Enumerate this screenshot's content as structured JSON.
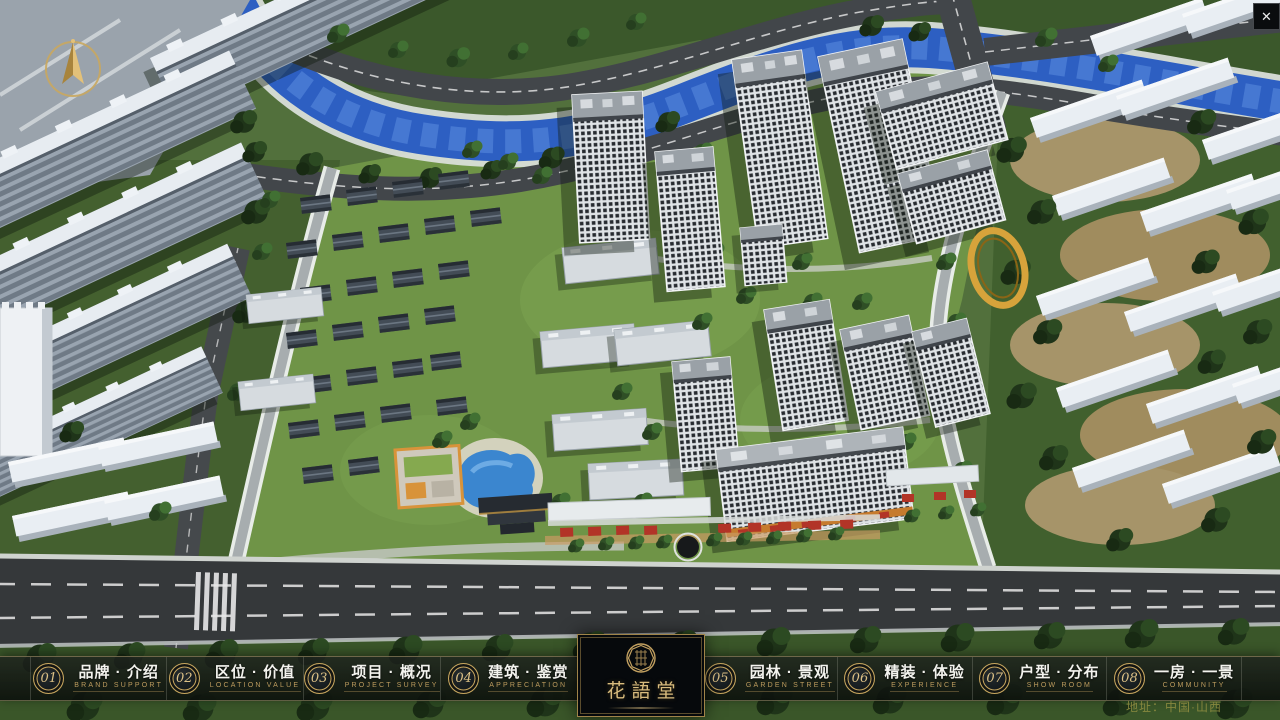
{
  "app": {
    "close_glyph": "✕"
  },
  "nav": {
    "left": [
      {
        "num": "01",
        "title": "品牌 · 介绍",
        "subtitle": "BRAND SUPPORT"
      },
      {
        "num": "02",
        "title": "区位 · 价值",
        "subtitle": "LOCATION VALUE"
      },
      {
        "num": "03",
        "title": "项目 · 概况",
        "subtitle": "PROJECT SURVEY"
      },
      {
        "num": "04",
        "title": "建筑 · 鉴赏",
        "subtitle": "APPRECIATION"
      }
    ],
    "right": [
      {
        "num": "05",
        "title": "园林 · 景观",
        "subtitle": "GARDEN STREET"
      },
      {
        "num": "06",
        "title": "精装 · 体验",
        "subtitle": "EXPERIENCE"
      },
      {
        "num": "07",
        "title": "户型 · 分布",
        "subtitle": "SHOW ROOM"
      },
      {
        "num": "08",
        "title": "一房 · 一景",
        "subtitle": "COMMUNITY"
      }
    ]
  },
  "logo": {
    "title": "花語堂"
  },
  "footer": {
    "address": "地址：中国·山西"
  },
  "colors": {
    "gold": "#c8a75f",
    "bar_bg": "#10140f",
    "river": "#2d5fc2",
    "accent_red": "#b23427"
  }
}
